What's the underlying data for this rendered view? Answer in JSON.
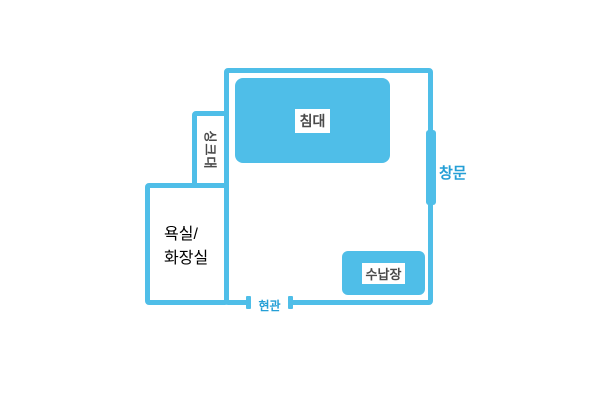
{
  "colors": {
    "shape_blue": "#4FBEE8",
    "label_text_dark": "#4A4A4A",
    "label_text_blue": "#259FD6",
    "background": "#FFFFFF",
    "label_bg": "#FFFFFF"
  },
  "floorplan": {
    "bed": {
      "label": "침대"
    },
    "sink": {
      "label": "싱크대"
    },
    "bathroom": {
      "label_line1": "욕실/",
      "label_line2": "화장실"
    },
    "storage": {
      "label": "수납장"
    },
    "window": {
      "label": "창문"
    },
    "entrance": {
      "label": "현관"
    }
  }
}
